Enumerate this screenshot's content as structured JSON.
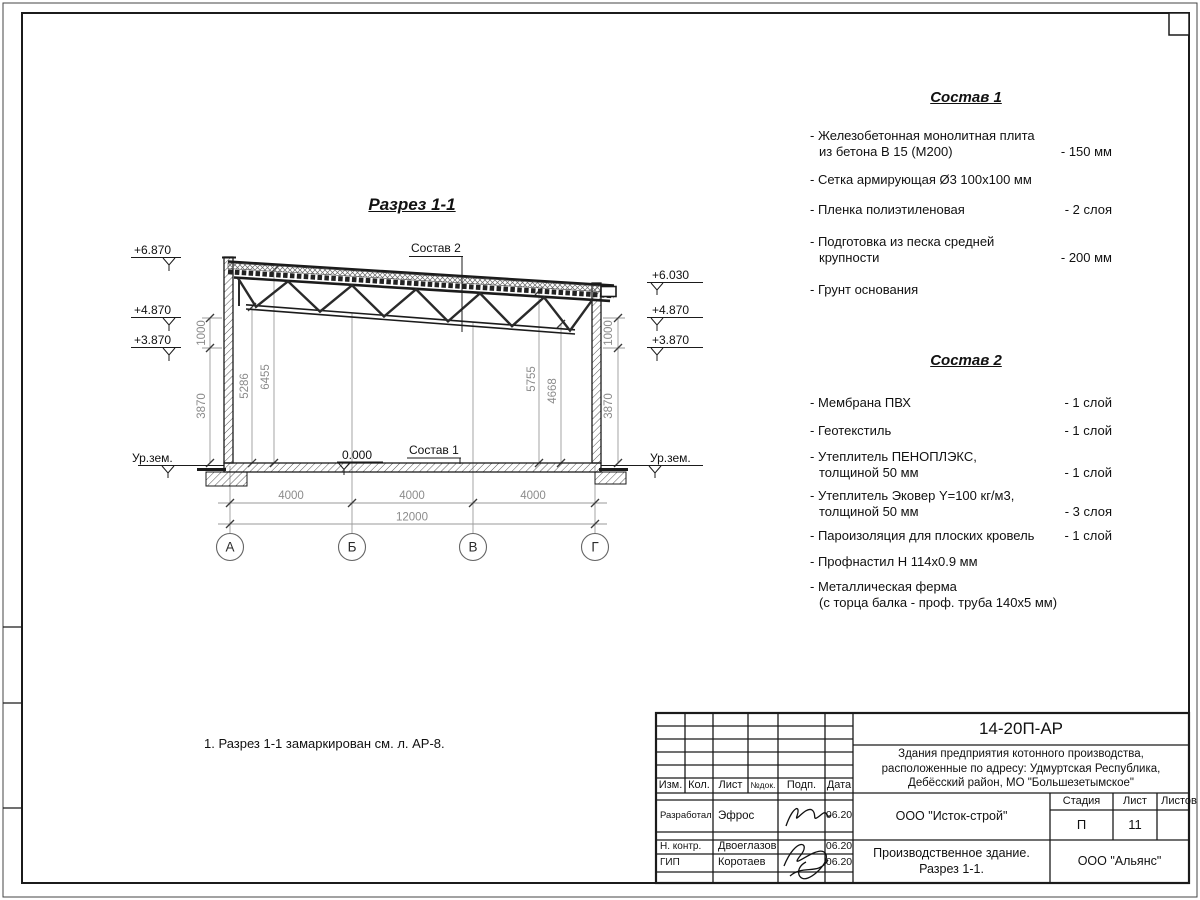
{
  "frame": {
    "corner_box": ""
  },
  "note": "1. Разрез 1-1 замаркирован см. л. АР-8.",
  "drawing": {
    "title": "Разрез 1-1",
    "sostav1_label": "Состав 1",
    "sostav2_label": "Состав 2",
    "zero_mark": "0.000",
    "ground_label": "Ур.зем.",
    "elev_left": [
      "+6.870",
      "+4.870",
      "+3.870"
    ],
    "elev_right": [
      "+6.030",
      "+4.870",
      "+3.870"
    ],
    "dim_span": "4000",
    "dim_total": "12000",
    "dim_1000": "1000",
    "dim_3870": "3870",
    "dim_5286": "5286",
    "dim_6455": "6455",
    "dim_5755": "5755",
    "dim_4668": "4668",
    "axes": [
      "А",
      "Б",
      "В",
      "Г"
    ]
  },
  "sostav1": {
    "title": "Состав 1",
    "items": [
      {
        "line1": "- Железобетонная  монолитная плита",
        "line2": "из бетона В 15 (М200)",
        "value": "- 150 мм"
      },
      {
        "line1": "- Сетка армирующая Ø3 100x100 мм",
        "line2": "",
        "value": ""
      },
      {
        "line1": "- Пленка полиэтиленовая",
        "line2": "",
        "value": "- 2 слоя"
      },
      {
        "line1": "- Подготовка из песка средней",
        "line2": "крупности",
        "value": "- 200 мм"
      },
      {
        "line1": "- Грунт основания",
        "line2": "",
        "value": ""
      }
    ]
  },
  "sostav2": {
    "title": "Состав 2",
    "items": [
      {
        "line1": "- Мембрана ПВХ",
        "line2": "",
        "value": "- 1 слой"
      },
      {
        "line1": "- Геотекстиль",
        "line2": "",
        "value": "- 1 слой"
      },
      {
        "line1": "- Утеплитель ПЕНОПЛЭКС,",
        "line2": "толщиной 50 мм",
        "value": "- 1 слой"
      },
      {
        "line1": "- Утеплитель Эковер Y=100 кг/м3,",
        "line2": "толщиной 50 мм",
        "value": "- 3 слоя"
      },
      {
        "line1": "- Пароизоляция для плоских кровель",
        "line2": "",
        "value": "- 1 слой"
      },
      {
        "line1": "- Профнастил Н 114x0.9 мм",
        "line2": "",
        "value": ""
      },
      {
        "line1": "- Металлическая ферма",
        "line2": "(с торца балка - проф. труба 140x5 мм)",
        "value": ""
      }
    ]
  },
  "titleblock": {
    "doc_code": "14-20П-АР",
    "project_line1": "Здания предприятия котонного производства,",
    "project_line2": "расположенные по адресу: Удмуртская Республика,",
    "project_line3": "Дебёсский район, МО \"Большезетымское\"",
    "org1": "ООО \"Исток-строй\"",
    "drawing_name_line1": "Производственное здание.",
    "drawing_name_line2": "Разрез 1-1.",
    "org2": "ООО \"Альянс\"",
    "col_headers": {
      "izm": "Изм.",
      "kol": "Кол.",
      "list": "Лист",
      "ndok": "№док.",
      "podp": "Подп.",
      "data": "Дата"
    },
    "stage_headers": {
      "stadia": "Стадия",
      "list": "Лист",
      "listov": "Листов"
    },
    "stage": "П",
    "sheet_number": "11",
    "sheets_total": "",
    "rows": [
      {
        "role": "Разработал",
        "name": "Эфрос",
        "date": "06.20"
      },
      {
        "role": "Н. контр.",
        "name": "Двоеглазов",
        "date": "06.20"
      },
      {
        "role": "ГИП",
        "name": "Коротаев",
        "date": "06.20"
      }
    ]
  }
}
